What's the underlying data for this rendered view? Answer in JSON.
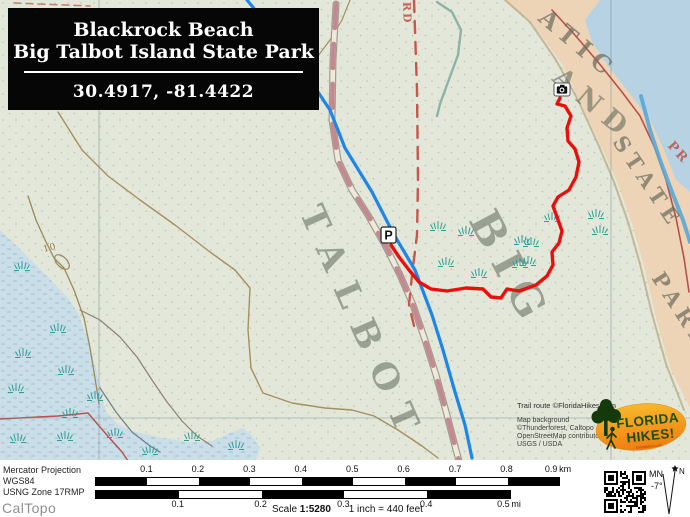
{
  "title_card": {
    "line1": "Blackrock Beach",
    "line2": "Big Talbot Island State Park",
    "coords": "30.4917, -81.4422"
  },
  "attribution": {
    "trail_credit": "Trail route ©FloridaHikes.com",
    "background_credit": [
      "Map background",
      "©Thunderforest, Caltopo",
      "OpenStreetMap contributors,",
      "USGS / USDA"
    ]
  },
  "logo": {
    "word1": "FLORIDA",
    "word2": "HIKES!",
    "tagline": "floridahikes.com"
  },
  "footer": {
    "projection": "Mercator Projection",
    "datum": "WGS84",
    "usng": "USNG Zone 17RMP",
    "brand": "CalTopo",
    "scale_label_prefix": "Scale",
    "scale_value": "1:5280",
    "scale_equiv": "1 inch = 440 feet",
    "km_bar": {
      "x0": 95,
      "x1": 558,
      "ticks": [
        "0.1",
        "0.2",
        "0.3",
        "0.4",
        "0.5",
        "0.6",
        "0.7",
        "0.8",
        "0.9"
      ],
      "unit": "km"
    },
    "mi_bar": {
      "x0": 95,
      "x1": 509,
      "ticks": [
        "0.1",
        "0.2",
        "0.3",
        "0.4",
        "0.5"
      ],
      "unit": "mi"
    },
    "compass": {
      "mn_label": "MN",
      "declination": "-7°",
      "north_label": "N"
    }
  },
  "map": {
    "w": 690,
    "h": 461,
    "colors": {
      "land": "#e2e7d9",
      "dots": "#b9c4ae",
      "marsh": "#cadee8",
      "marsh_line": "#9fc2d2",
      "beach": "#eed4b6",
      "ocean": "#b7d3e3",
      "trail": "#e8100c",
      "stream": "#1d86e8"
    },
    "polys": [
      {
        "name": "beach-strip",
        "fill": "#eed4b6",
        "pts": [
          [
            505,
            0
          ],
          [
            690,
            0
          ],
          [
            690,
            408
          ],
          [
            670,
            368
          ],
          [
            656,
            318
          ],
          [
            644,
            266
          ],
          [
            632,
            224
          ],
          [
            618,
            184
          ],
          [
            602,
            148
          ],
          [
            584,
            110
          ],
          [
            562,
            64
          ],
          [
            530,
            20
          ]
        ]
      },
      {
        "name": "ocean",
        "fill": "#b7d3e3",
        "pts": [
          [
            600,
            0
          ],
          [
            690,
            0
          ],
          [
            690,
            192
          ],
          [
            676,
            180
          ],
          [
            664,
            150
          ],
          [
            650,
            120
          ],
          [
            630,
            94
          ],
          [
            608,
            66
          ],
          [
            592,
            42
          ],
          [
            585,
            20
          ]
        ]
      },
      {
        "name": "salt-marsh",
        "fill": "marsh",
        "pts": [
          [
            0,
            230
          ],
          [
            18,
            247
          ],
          [
            48,
            277
          ],
          [
            67,
            297
          ],
          [
            78,
            313
          ],
          [
            88,
            340
          ],
          [
            97,
            372
          ],
          [
            101,
            392
          ],
          [
            106,
            412
          ],
          [
            118,
            424
          ],
          [
            132,
            431
          ],
          [
            158,
            437
          ],
          [
            188,
            442
          ],
          [
            212,
            441
          ],
          [
            230,
            433
          ],
          [
            243,
            428
          ],
          [
            252,
            436
          ],
          [
            260,
            448
          ],
          [
            256,
            461
          ],
          [
            0,
            461
          ]
        ]
      }
    ],
    "paths": [
      {
        "name": "beach-inner-edge",
        "pts": [
          [
            505,
            0
          ],
          [
            530,
            22
          ],
          [
            556,
            60
          ],
          [
            578,
            100
          ],
          [
            598,
            144
          ],
          [
            614,
            182
          ],
          [
            628,
            222
          ],
          [
            640,
            264
          ],
          [
            652,
            314
          ],
          [
            666,
            364
          ],
          [
            684,
            410
          ]
        ],
        "stroke": "#b09a68",
        "w": 2,
        "opacity": 0.6
      },
      {
        "name": "corner-dashes",
        "pts": [
          [
            14,
            3
          ],
          [
            90,
            6
          ]
        ],
        "stroke": "#c87868",
        "w": 1.5,
        "dash": "7 5"
      },
      {
        "name": "contour-main",
        "pts": [
          [
            58,
            112
          ],
          [
            82,
            150
          ],
          [
            108,
            176
          ],
          [
            140,
            200
          ],
          [
            175,
            225
          ],
          [
            210,
            252
          ],
          [
            235,
            270
          ],
          [
            250,
            288
          ],
          [
            248,
            330
          ],
          [
            251,
            368
          ],
          [
            263,
            393
          ],
          [
            292,
            403
          ],
          [
            325,
            408
          ],
          [
            352,
            410
          ],
          [
            374,
            416
          ],
          [
            398,
            430
          ],
          [
            422,
            446
          ],
          [
            438,
            458
          ]
        ],
        "stroke": "#a5905e",
        "w": 1.4
      },
      {
        "name": "contour-left",
        "pts": [
          [
            80,
            310
          ],
          [
            100,
            320
          ],
          [
            120,
            337
          ],
          [
            137,
            357
          ],
          [
            152,
            380
          ],
          [
            167,
            402
          ],
          [
            182,
            421
          ],
          [
            197,
            436
          ],
          [
            212,
            446
          ]
        ],
        "stroke": "#8c8272",
        "w": 1.2
      },
      {
        "name": "contour-10",
        "pts": [
          [
            28,
            196
          ],
          [
            36,
            220
          ],
          [
            46,
            242
          ],
          [
            54,
            258
          ],
          [
            64,
            268
          ],
          [
            74,
            290
          ],
          [
            84,
            318
          ],
          [
            90,
            348
          ],
          [
            95,
            378
          ],
          [
            99,
            404
          ]
        ],
        "stroke": "#9c8a5a",
        "w": 1.3
      },
      {
        "name": "contour-top",
        "pts": [
          [
            350,
            0
          ],
          [
            342,
            20
          ],
          [
            330,
            40
          ],
          [
            318,
            56
          ]
        ],
        "stroke": "#a5905e",
        "w": 1.2
      },
      {
        "name": "creek-teal",
        "pts": [
          [
            437,
            2
          ],
          [
            452,
            12
          ],
          [
            461,
            30
          ],
          [
            458,
            55
          ],
          [
            448,
            82
          ],
          [
            440,
            104
          ],
          [
            437,
            116
          ]
        ],
        "stroke": "#7fa89f",
        "w": 2.4,
        "opacity": 0.85
      },
      {
        "name": "marsh-gray-line",
        "pts": [
          [
            100,
            388
          ],
          [
            116,
            412
          ],
          [
            132,
            432
          ],
          [
            150,
            446
          ],
          [
            160,
            452
          ]
        ],
        "stroke": "#6f7f87",
        "w": 1.2
      },
      {
        "name": "road-red-sw",
        "pts": [
          [
            0,
            419
          ],
          [
            58,
            416
          ],
          [
            88,
            413
          ],
          [
            106,
            434
          ],
          [
            122,
            452
          ],
          [
            128,
            461
          ]
        ],
        "stroke": "#b8544e",
        "w": 1.5
      },
      {
        "name": "grid-v-west",
        "pts": [
          [
            99,
            0
          ],
          [
            99,
            461
          ]
        ],
        "stroke": "#7f9098",
        "w": 1,
        "opacity": 0.55
      },
      {
        "name": "grid-v-east",
        "pts": [
          [
            611,
            0
          ],
          [
            611,
            461
          ]
        ],
        "stroke": "#7f9098",
        "w": 1,
        "opacity": 0.55
      },
      {
        "name": "grid-h",
        "pts": [
          [
            0,
            418
          ],
          [
            690,
            418
          ]
        ],
        "stroke": "#7f9098",
        "w": 1,
        "opacity": 0.45
      },
      {
        "name": "coast-road-red",
        "pts": [
          [
            552,
            10
          ],
          [
            574,
            34
          ],
          [
            598,
            62
          ],
          [
            622,
            92
          ],
          [
            640,
            116
          ],
          [
            654,
            146
          ],
          [
            666,
            180
          ],
          [
            676,
            218
          ],
          [
            684,
            258
          ],
          [
            689,
            292
          ]
        ],
        "stroke": "#b8504c",
        "w": 1.6
      },
      {
        "name": "beach-river",
        "pts": [
          [
            641,
            96
          ],
          [
            650,
            130
          ],
          [
            660,
            160
          ],
          [
            672,
            192
          ],
          [
            683,
            220
          ],
          [
            690,
            242
          ]
        ],
        "stroke": "#58a8d8",
        "w": 4,
        "opacity": 0.9
      }
    ],
    "road": {
      "pts": [
        [
          336,
          4
        ],
        [
          333,
          60
        ],
        [
          332,
          120
        ],
        [
          338,
          160
        ],
        [
          352,
          190
        ],
        [
          368,
          215
        ],
        [
          385,
          245
        ],
        [
          400,
          275
        ],
        [
          413,
          305
        ],
        [
          425,
          340
        ],
        [
          436,
          375
        ],
        [
          447,
          415
        ],
        [
          456,
          450
        ],
        [
          459,
          461
        ]
      ],
      "casing": "#9a9488",
      "fill": "#efe9dc",
      "dash_color": "#c4898e",
      "dash": "24 16"
    },
    "boundary": {
      "pts": [
        [
          414,
          0
        ],
        [
          417,
          90
        ],
        [
          418,
          180
        ],
        [
          417,
          235
        ],
        [
          412,
          275
        ],
        [
          409,
          305
        ],
        [
          415,
          330
        ]
      ],
      "stroke": "#c9564c",
      "w": 2.4,
      "dash": "12 9"
    },
    "stream": {
      "pts": [
        [
          247,
          0
        ],
        [
          280,
          40
        ],
        [
          310,
          80
        ],
        [
          330,
          110
        ],
        [
          345,
          148
        ],
        [
          372,
          192
        ],
        [
          393,
          233
        ],
        [
          415,
          270
        ],
        [
          432,
          315
        ],
        [
          443,
          350
        ],
        [
          455,
          392
        ],
        [
          465,
          425
        ],
        [
          472,
          458
        ]
      ]
    },
    "contour_loop": {
      "cx": 62,
      "cy": 262,
      "rx": 9,
      "ry": 5,
      "rot": 45,
      "stroke": "#9c8a5a"
    },
    "labels": [
      {
        "text": "ATIC",
        "x": 537,
        "y": 20,
        "rot": 40,
        "size": 24,
        "spacing": 7,
        "color": "rgba(112,112,96,0.75)",
        "weight": 600
      },
      {
        "text": "AND",
        "x": 551,
        "y": 80,
        "rot": 40,
        "size": 27,
        "spacing": 9,
        "color": "rgba(110,115,100,0.65)",
        "weight": 600
      },
      {
        "text": "STATE",
        "x": 612,
        "y": 142,
        "rot": 56,
        "size": 21,
        "spacing": 6,
        "color": "rgba(112,112,96,0.75)",
        "weight": 600
      },
      {
        "text": "PARK",
        "x": 651,
        "y": 278,
        "rot": 57,
        "size": 21,
        "spacing": 6,
        "color": "rgba(112,112,96,0.75)",
        "weight": 600
      },
      {
        "text": "BIG",
        "x": 468,
        "y": 220,
        "rot": 62,
        "size": 42,
        "spacing": 12,
        "color": "rgba(95,104,90,0.55)",
        "weight": 700
      },
      {
        "text": "TALBOT",
        "x": 299,
        "y": 212,
        "rot": 66,
        "size": 35,
        "spacing": 16,
        "color": "rgba(95,104,90,0.55)",
        "weight": 700
      },
      {
        "text": "PR",
        "x": 667,
        "y": 146,
        "rot": 48,
        "size": 13,
        "spacing": 2,
        "color": "rgba(190,90,80,0.9)",
        "weight": 600
      },
      {
        "text": "RD",
        "x": 403,
        "y": 2,
        "rot": 88,
        "size": 11,
        "spacing": 2,
        "color": "rgba(195,85,75,0.9)",
        "weight": 600
      },
      {
        "text": "10",
        "x": 44,
        "y": 252,
        "rot": -15,
        "size": 9,
        "spacing": 1,
        "color": "#8e7a46",
        "weight": 400
      }
    ],
    "marsh_symbols": {
      "teal": [
        [
          438,
          228
        ],
        [
          466,
          233
        ],
        [
          522,
          242
        ],
        [
          446,
          264
        ],
        [
          479,
          275
        ],
        [
          520,
          265
        ],
        [
          552,
          219
        ],
        [
          531,
          244
        ],
        [
          528,
          263
        ],
        [
          596,
          216
        ],
        [
          600,
          232
        ],
        [
          22,
          268
        ],
        [
          58,
          330
        ],
        [
          23,
          355
        ],
        [
          66,
          372
        ],
        [
          16,
          390
        ],
        [
          70,
          415
        ],
        [
          18,
          440
        ],
        [
          65,
          438
        ],
        [
          95,
          398
        ],
        [
          115,
          435
        ],
        [
          150,
          452
        ],
        [
          192,
          438
        ],
        [
          236,
          447
        ]
      ],
      "gray": [
        [
          615,
          428
        ],
        [
          644,
          442
        ]
      ]
    },
    "trail": {
      "color": "#e8100c",
      "width": 3.4,
      "pts": [
        [
          391,
          245
        ],
        [
          399,
          257
        ],
        [
          409,
          270
        ],
        [
          419,
          282
        ],
        [
          431,
          289
        ],
        [
          447,
          291
        ],
        [
          466,
          288
        ],
        [
          483,
          289
        ],
        [
          491,
          297
        ],
        [
          501,
          298
        ],
        [
          507,
          289
        ],
        [
          519,
          291
        ],
        [
          536,
          285
        ],
        [
          547,
          276
        ],
        [
          553,
          265
        ],
        [
          552,
          252
        ],
        [
          559,
          243
        ],
        [
          562,
          231
        ],
        [
          557,
          217
        ],
        [
          553,
          206
        ],
        [
          558,
          197
        ],
        [
          569,
          190
        ],
        [
          576,
          177
        ],
        [
          579,
          162
        ],
        [
          575,
          149
        ],
        [
          568,
          141
        ],
        [
          567,
          128
        ],
        [
          571,
          116
        ],
        [
          565,
          106
        ],
        [
          557,
          104
        ],
        [
          560,
          98
        ]
      ]
    },
    "markers": {
      "parking": {
        "x": 381,
        "y": 227,
        "w": 15,
        "h": 16,
        "label": "P"
      },
      "camera": {
        "x": 554,
        "y": 83,
        "w": 16,
        "h": 13
      }
    }
  }
}
